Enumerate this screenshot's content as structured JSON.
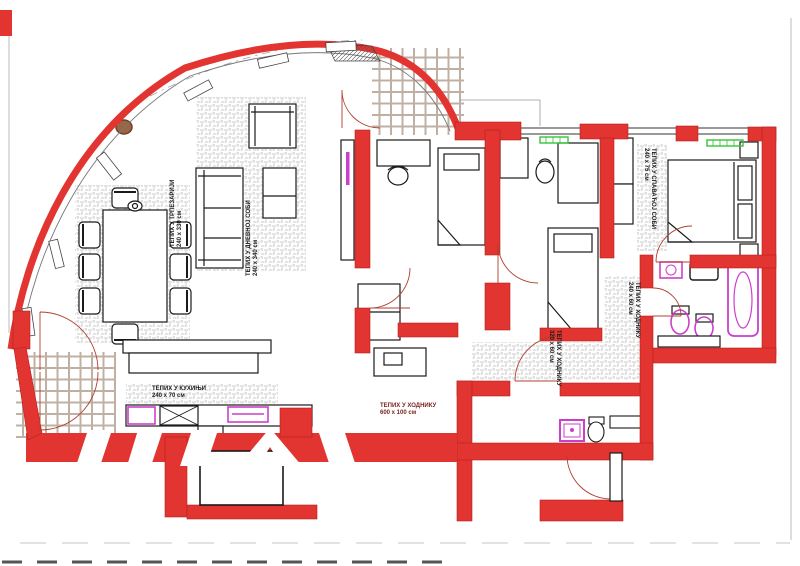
{
  "drawing": {
    "type": "apartment-floor-plan",
    "units": "cm"
  },
  "labels": {
    "dining_rug": {
      "line1": "ТЕПИХ У ТРПЕЗАРИЈИ",
      "line2": "240 х 330 см"
    },
    "living_rug": {
      "line1": "ТЕПИХ У ДНЕВНОЈ СОБИ",
      "line2": "240 х 340 см"
    },
    "kitchen_rug": {
      "line1": "ТЕПИХ У КУХИЊИ",
      "line2": "240 х 70 см"
    },
    "hallway_rug": {
      "line1": "ТЕПИХ У ХОДНИКУ",
      "line2": "600 х 100 см"
    },
    "bedroom_rug": {
      "line1": "ТЕПИХ У СПАВАЋОЈ СОБИ",
      "line2": "240 х 75 см"
    },
    "corridor_rug_left": {
      "line1": "ТЕПИХ У ХОДНИКУ",
      "line2": "320 х 60 см"
    },
    "corridor_rug_right": {
      "line1": "ТЕПИХ У ХОДНИКУ",
      "line2": "240 х 60 см"
    }
  },
  "colors": {
    "wall_red": "#e23430",
    "wall_red_dark": "#b5231f",
    "fixture_magenta": "#cc3fcc",
    "radiator_green": "#35c435",
    "carpet_hatch_gray": "#c9c9c9",
    "tile_line_tan": "#c0b0a4",
    "outline_black": "#1a1a1a",
    "rug_circle_brown": "#9a6644",
    "hall_label_text": "#7a1f1f"
  }
}
